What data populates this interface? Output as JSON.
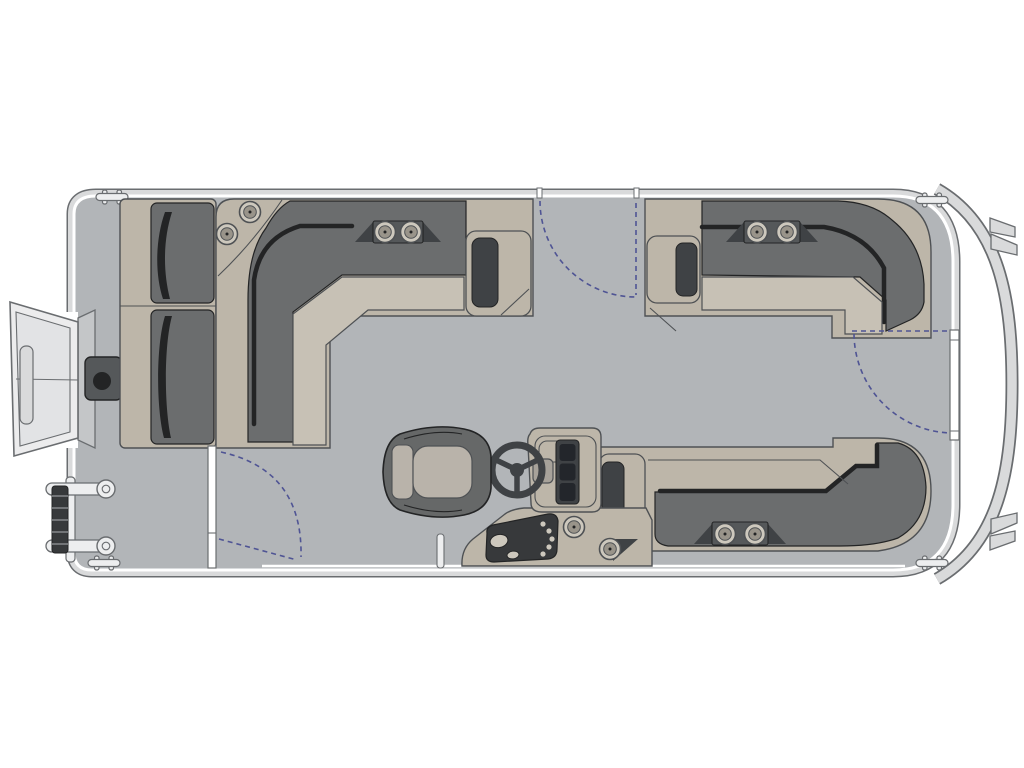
{
  "diagram": {
    "kind": "pontoon-boat-floorplan",
    "view": "top-down",
    "orientation": "bow-right"
  },
  "components": {
    "lounges": [
      "left-side-bench",
      "top-left-l-lounge",
      "top-right-l-lounge",
      "bottom-right-l-lounge"
    ],
    "cup_holder_count": 10,
    "gate_count": 3,
    "cleat_count": 4,
    "helm": [
      "helm-console",
      "steering-wheel",
      "gauge-cluster",
      "switch-panel"
    ],
    "captains_chair_count": 1,
    "boarding": [
      "stern-ramp",
      "boarding-ladder",
      "gate-latch-plate",
      "tow-pylon"
    ]
  },
  "colors": {
    "white": "#ffffff",
    "deck": "#b2b5b8",
    "rim": "#d9dadb",
    "hull_line": "#6a6d70",
    "outline": "#4e5154",
    "couch_light": "#bdb6a9",
    "couch_front": "#c7c1b5",
    "couch_dark": "#6b6d6e",
    "panel_dark": "#3f4245",
    "screen_dark": "#23262b",
    "shadow_dark": "#232425",
    "plate_dark": "#55585a",
    "chair_shell": "#666868",
    "chair_cushion": "#b9b3aa",
    "metal_light": "#edeeef",
    "coil_dark": "#37393b",
    "ramp_light": "#ececed",
    "ramp_inner": "#e2e3e5",
    "wedge": "#c4c6c8",
    "gate_arc": "#4f5494",
    "holder_ring": "#cdc8bd",
    "holder_inner": "#99948a"
  }
}
